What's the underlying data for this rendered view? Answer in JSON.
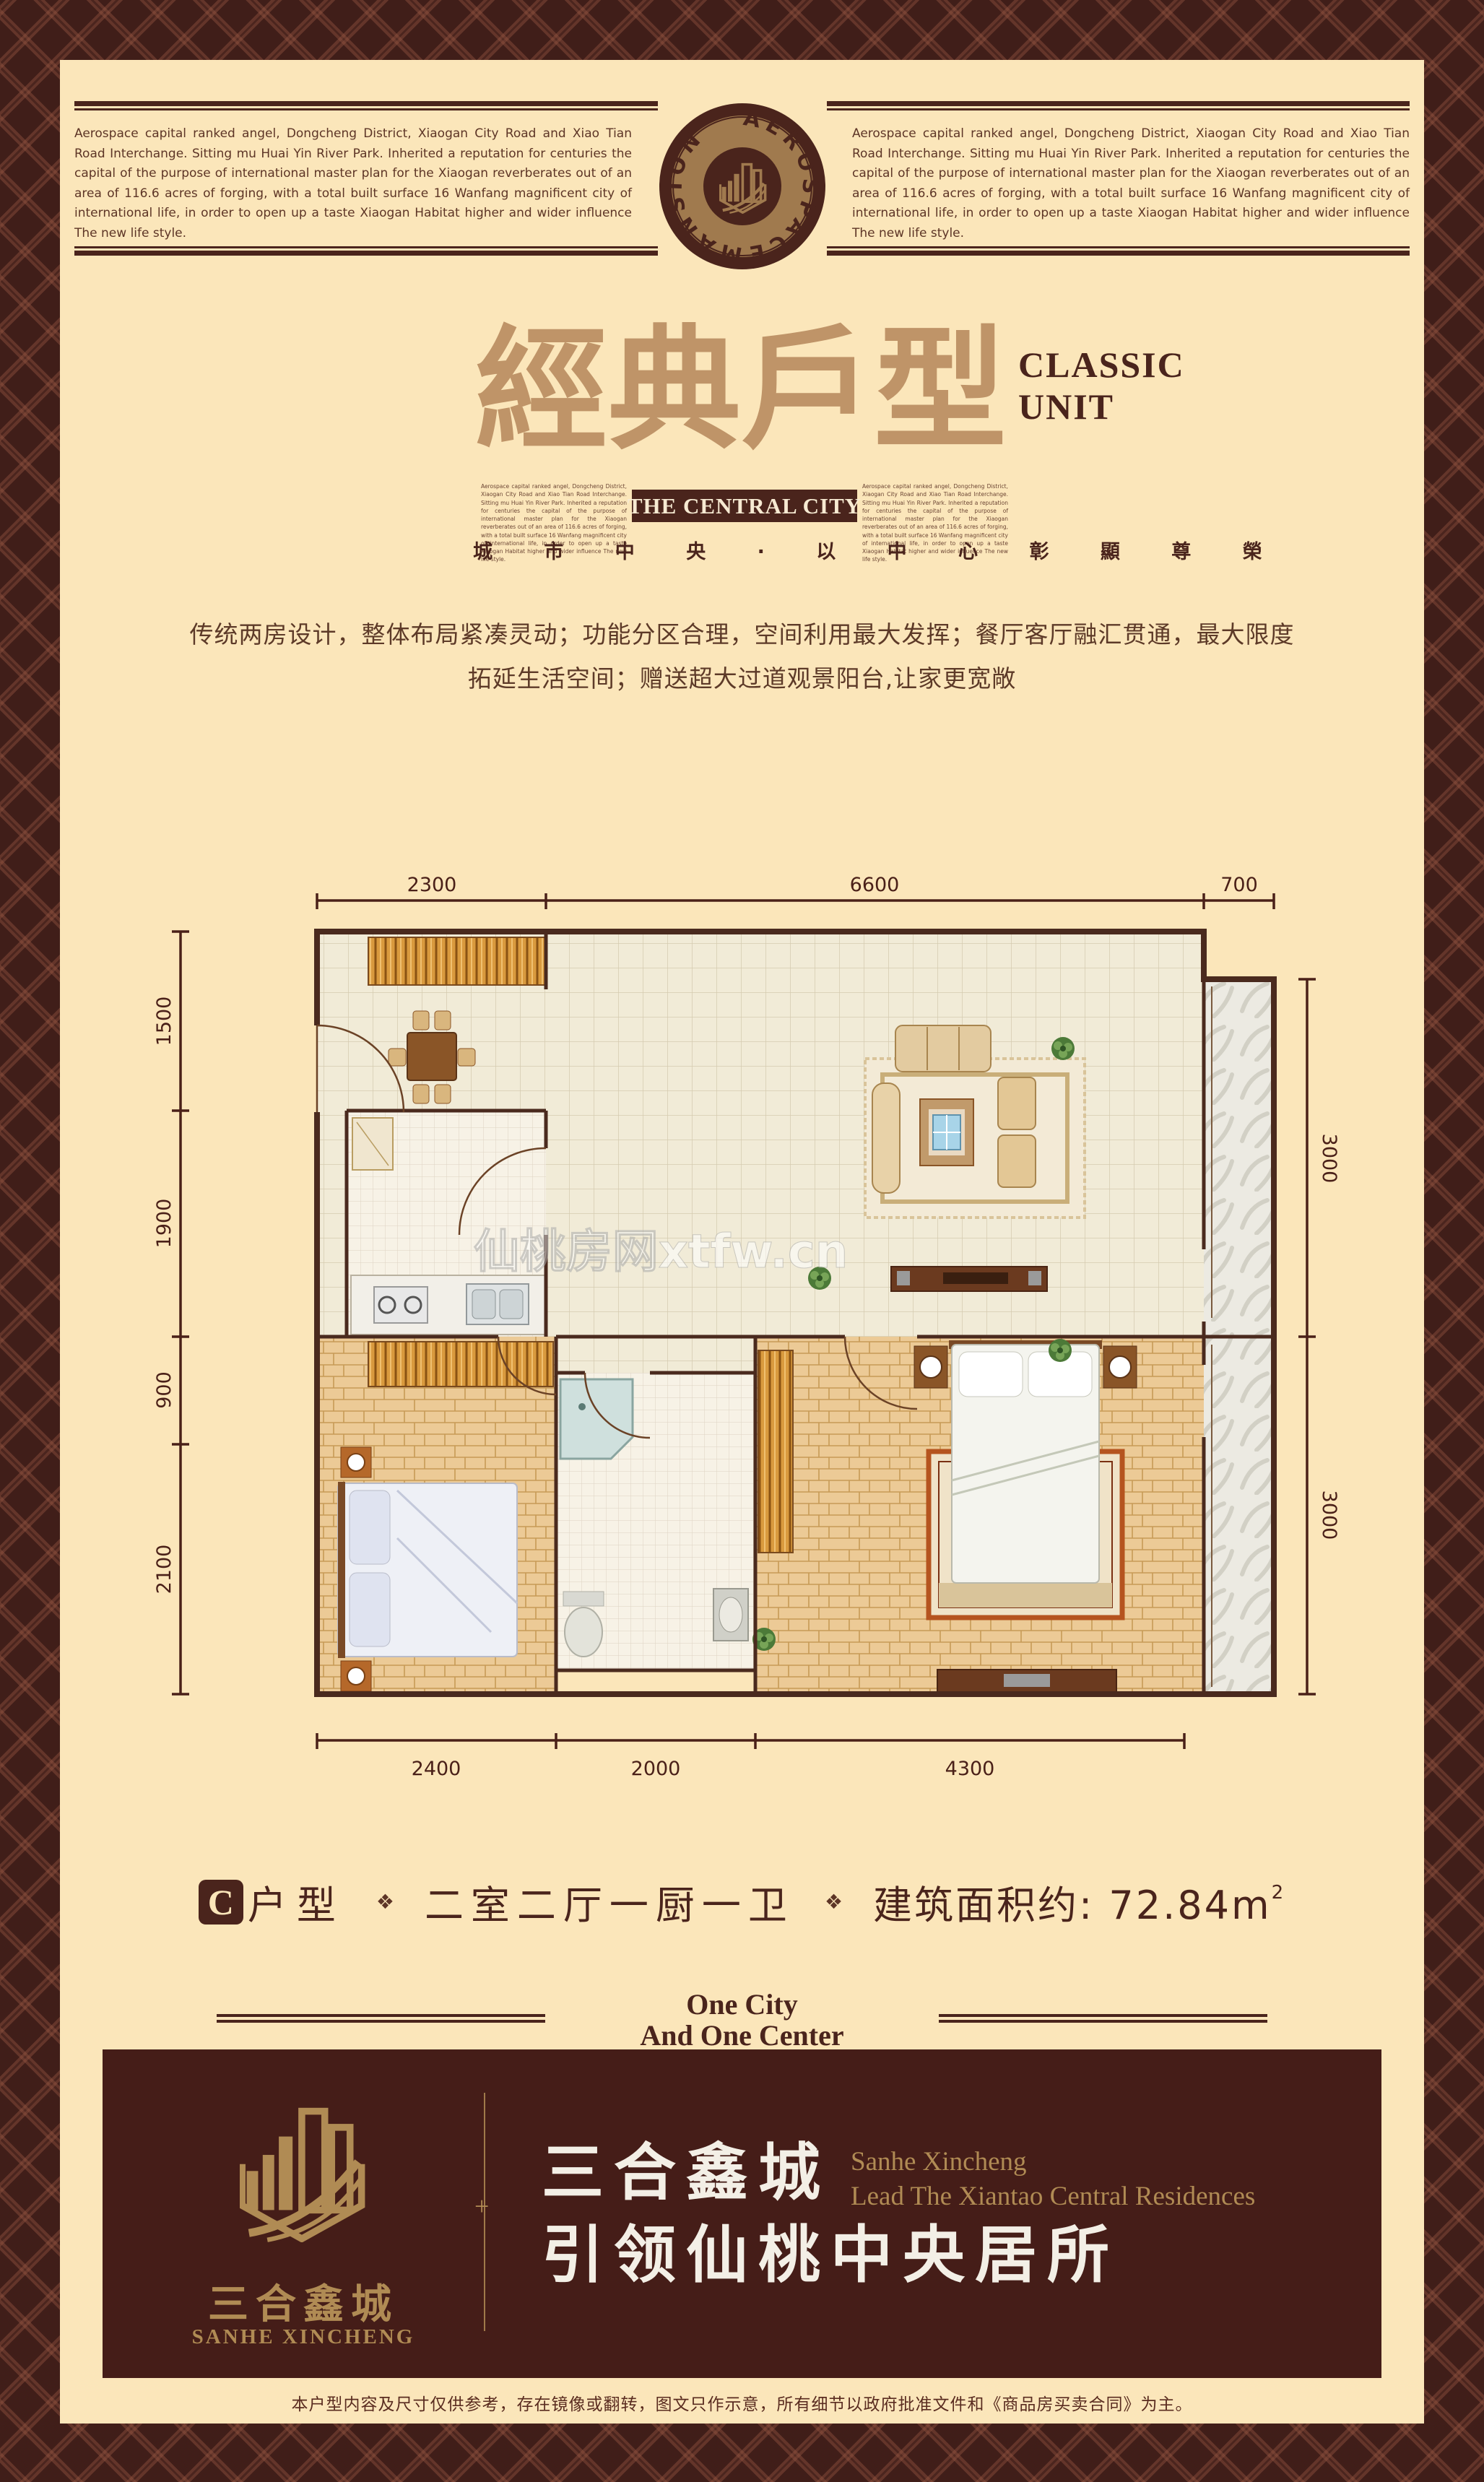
{
  "header": {
    "paragraph": "Aerospace capital ranked angel, Dongcheng District, Xiaogan City Road and Xiao Tian Road Interchange. Sitting mu Huai Yin River Park. Inherited a reputation for centuries the capital of the purpose of international master plan for the Xiaogan reverberates out of an area of 116.6 acres of forging, with a total built surface 16 Wanfang magnificent city of international life, in order to open up a taste Xiaogan Habitat higher and wider influence The new life style.",
    "logo_ring_text": "AEROSPACEMANSION"
  },
  "title": {
    "cjk": "經典戶型",
    "en_line1": "CLASSIC",
    "en_line2": "UNIT",
    "banner": "THE CENTRAL CITY",
    "subtitle_cjk": "城 市 中 央 · 以 中 心 彰 顯 尊 榮"
  },
  "description": {
    "line1": "传统两房设计，整体布局紧凑灵动；功能分区合理，空间利用最大发挥；餐厅客厅融汇贯通，最大限度",
    "line2": "拓延生活空间；赠送超大过道观景阳台,让家更宽敞"
  },
  "floorplan": {
    "watermark": "仙桃房网xtfw.cn",
    "dims_top": [
      "2300",
      "6600",
      "700"
    ],
    "dims_left": [
      "1500",
      "1900",
      "900",
      "2100"
    ],
    "dims_right": [
      "3000",
      "3000"
    ],
    "dims_bottom": [
      "2400",
      "2000",
      "4300"
    ]
  },
  "unit_info": {
    "type_letter": "C",
    "type_label": "户型",
    "separator": "❖",
    "rooms": "二室二厅一厨一卫",
    "area_text": "建筑面积约: 72.84m",
    "area_sup": "2"
  },
  "tagline": {
    "line1": "One City",
    "line2": "And One Center"
  },
  "footer_banner": {
    "brand_cjk": "三合鑫城",
    "brand_en": "SANHE XINCHENG",
    "slogan_cjk_1": "三合鑫城",
    "slogan_en_1": "Sanhe Xincheng",
    "slogan_en_2": "Lead The Xiantao Central Residences",
    "slogan_cjk_2": "引领仙桃中央居所",
    "divider_ornament": "+"
  },
  "disclaimer": "本户型内容及尺寸仅供参考，存在镜像或翻转，图文只作示意，所有细节以政府批准文件和《商品房买卖合同》为主。",
  "colors": {
    "page_cream": "#fbe6ba",
    "frame_brown": "#401e19",
    "accent_dark_brown": "#4a241c",
    "title_tan": "#bf9468",
    "banner_maroon": "#451d18",
    "gold": "#b08b54"
  }
}
